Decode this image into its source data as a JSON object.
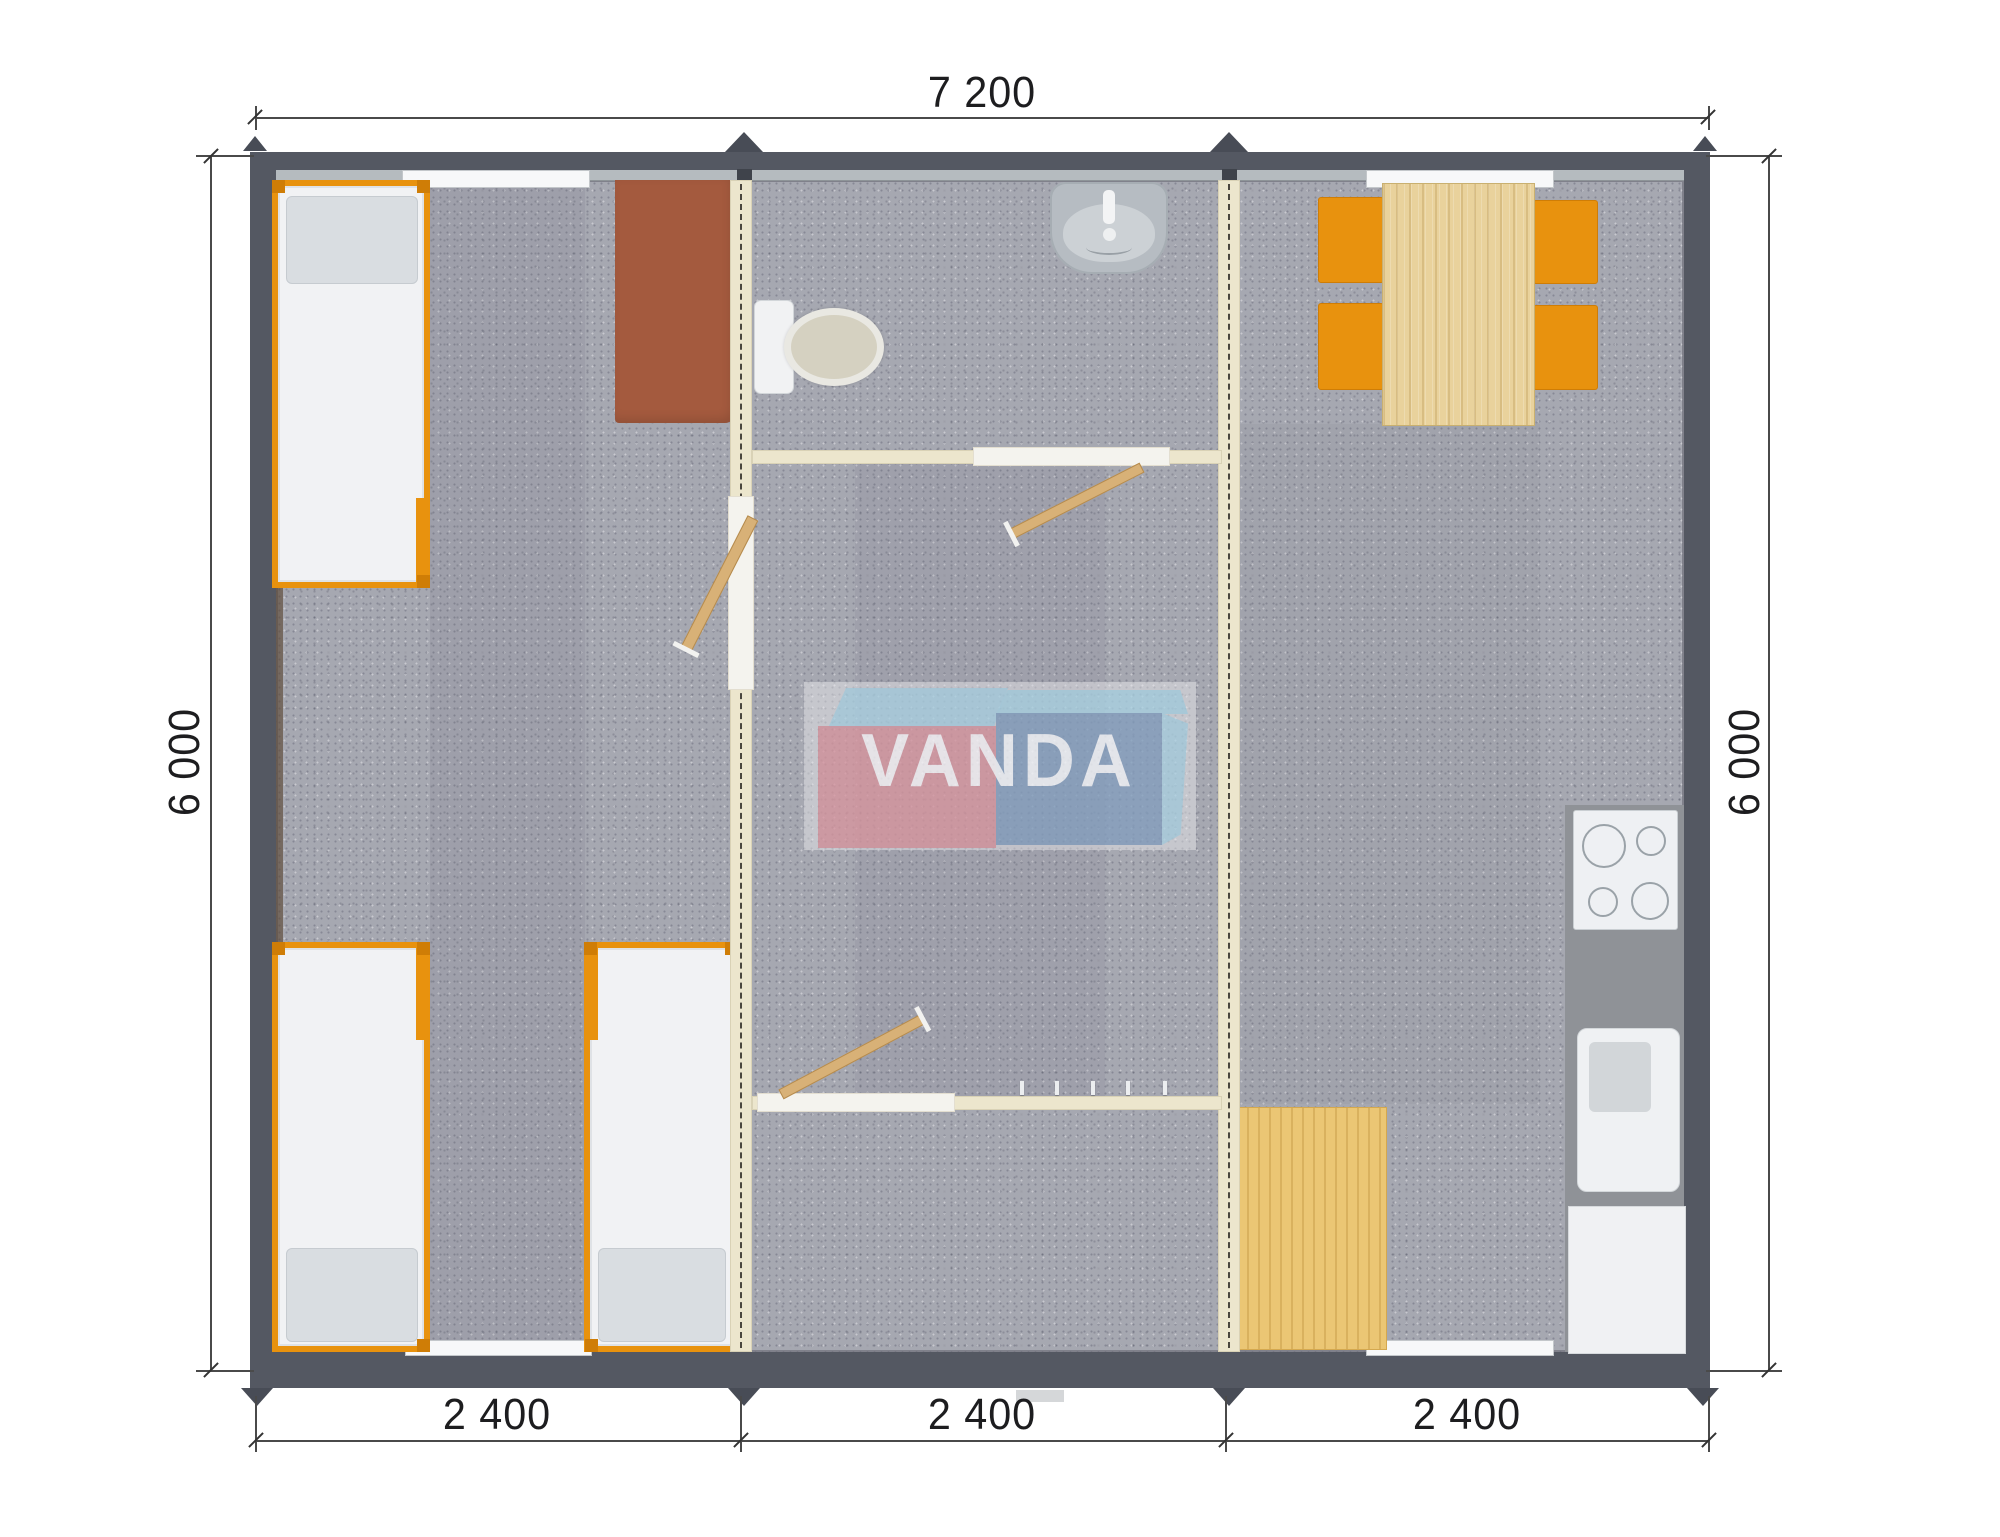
{
  "plan": {
    "overall_width_label": "7 200",
    "height_label_left": "6 000",
    "height_label_right": "6 000",
    "module_width_labels": [
      "2 400",
      "2 400",
      "2 400"
    ]
  },
  "logo": {
    "brand": "VANDA"
  },
  "modules": [
    {
      "name": "bedroom-module",
      "furniture": [
        "single-bed",
        "single-bed",
        "single-bed",
        "desk"
      ]
    },
    {
      "name": "bathroom-hall-module",
      "furniture": [
        "wash-basin",
        "toilet",
        "door",
        "door",
        "door",
        "coat-hooks"
      ]
    },
    {
      "name": "kitchen-dining-module",
      "furniture": [
        "dining-table",
        "chair",
        "chair",
        "chair",
        "chair",
        "cooktop",
        "kitchen-counter",
        "kitchen-sink",
        "kitchen-cabinet",
        "floor-mat"
      ]
    }
  ],
  "colors": {
    "wall": "#545862",
    "wallDark": "#3f434b",
    "sill": "#b5bbbf",
    "partition": "#ece6cd",
    "carpet": "#a6a8b1",
    "counter": "#8f9297",
    "orange": "#e8920e",
    "orangeDeep": "#cf7d06",
    "wood": "#e9d29c",
    "mat": "#ebc674",
    "desk": "#a45a3e",
    "fixture": "#b6bcc2",
    "white": "#f1f2f4",
    "logoPink": "#d78f99",
    "logoBlue": "#7e9abc",
    "logoSky": "#a5d0e2",
    "dimink": "#1d1d1f",
    "leaf": "#d8b177"
  }
}
